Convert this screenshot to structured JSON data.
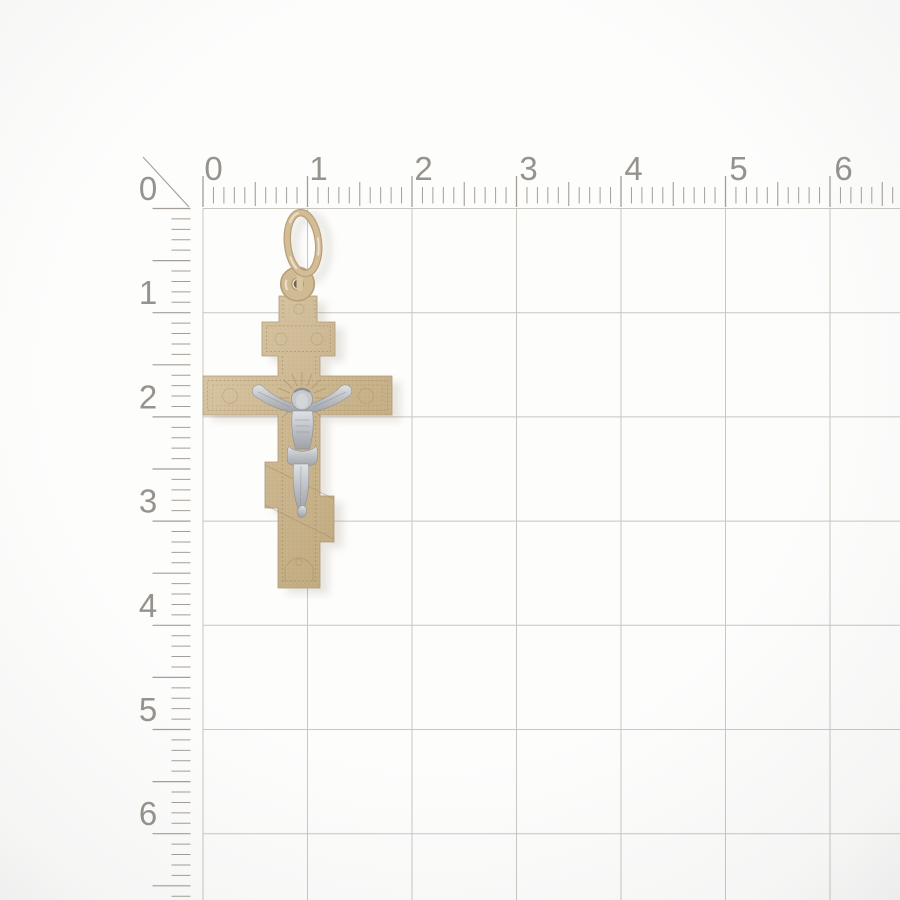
{
  "image": {
    "subject": "two-tone gold Orthodox three-bar crucifix cross pendant photographed on white measuring-grid background",
    "background_color": "#fdfdfc"
  },
  "rulers": {
    "top_numbers": [
      "0",
      "1",
      "2",
      "3",
      "4",
      "5",
      "6"
    ],
    "left_numbers": [
      "0",
      "1",
      "2",
      "3",
      "4",
      "5",
      "6"
    ],
    "number_color": "#8e8983",
    "tick_color": "#a49e97",
    "grid_line_color": "#cac6c0"
  },
  "pendant": {
    "type": "orthodox-three-bar-cross-crucifix",
    "metals": {
      "cross": "yellow-gold",
      "bail": "yellow-gold",
      "crucifix_figure": "white-gold"
    },
    "colors": {
      "gold_light": "#dac9a8",
      "gold_mid": "#c9b48e",
      "gold_dark": "#a8906a",
      "silver_light": "#dfe2e5",
      "silver_dark": "#9fa3a7"
    }
  }
}
